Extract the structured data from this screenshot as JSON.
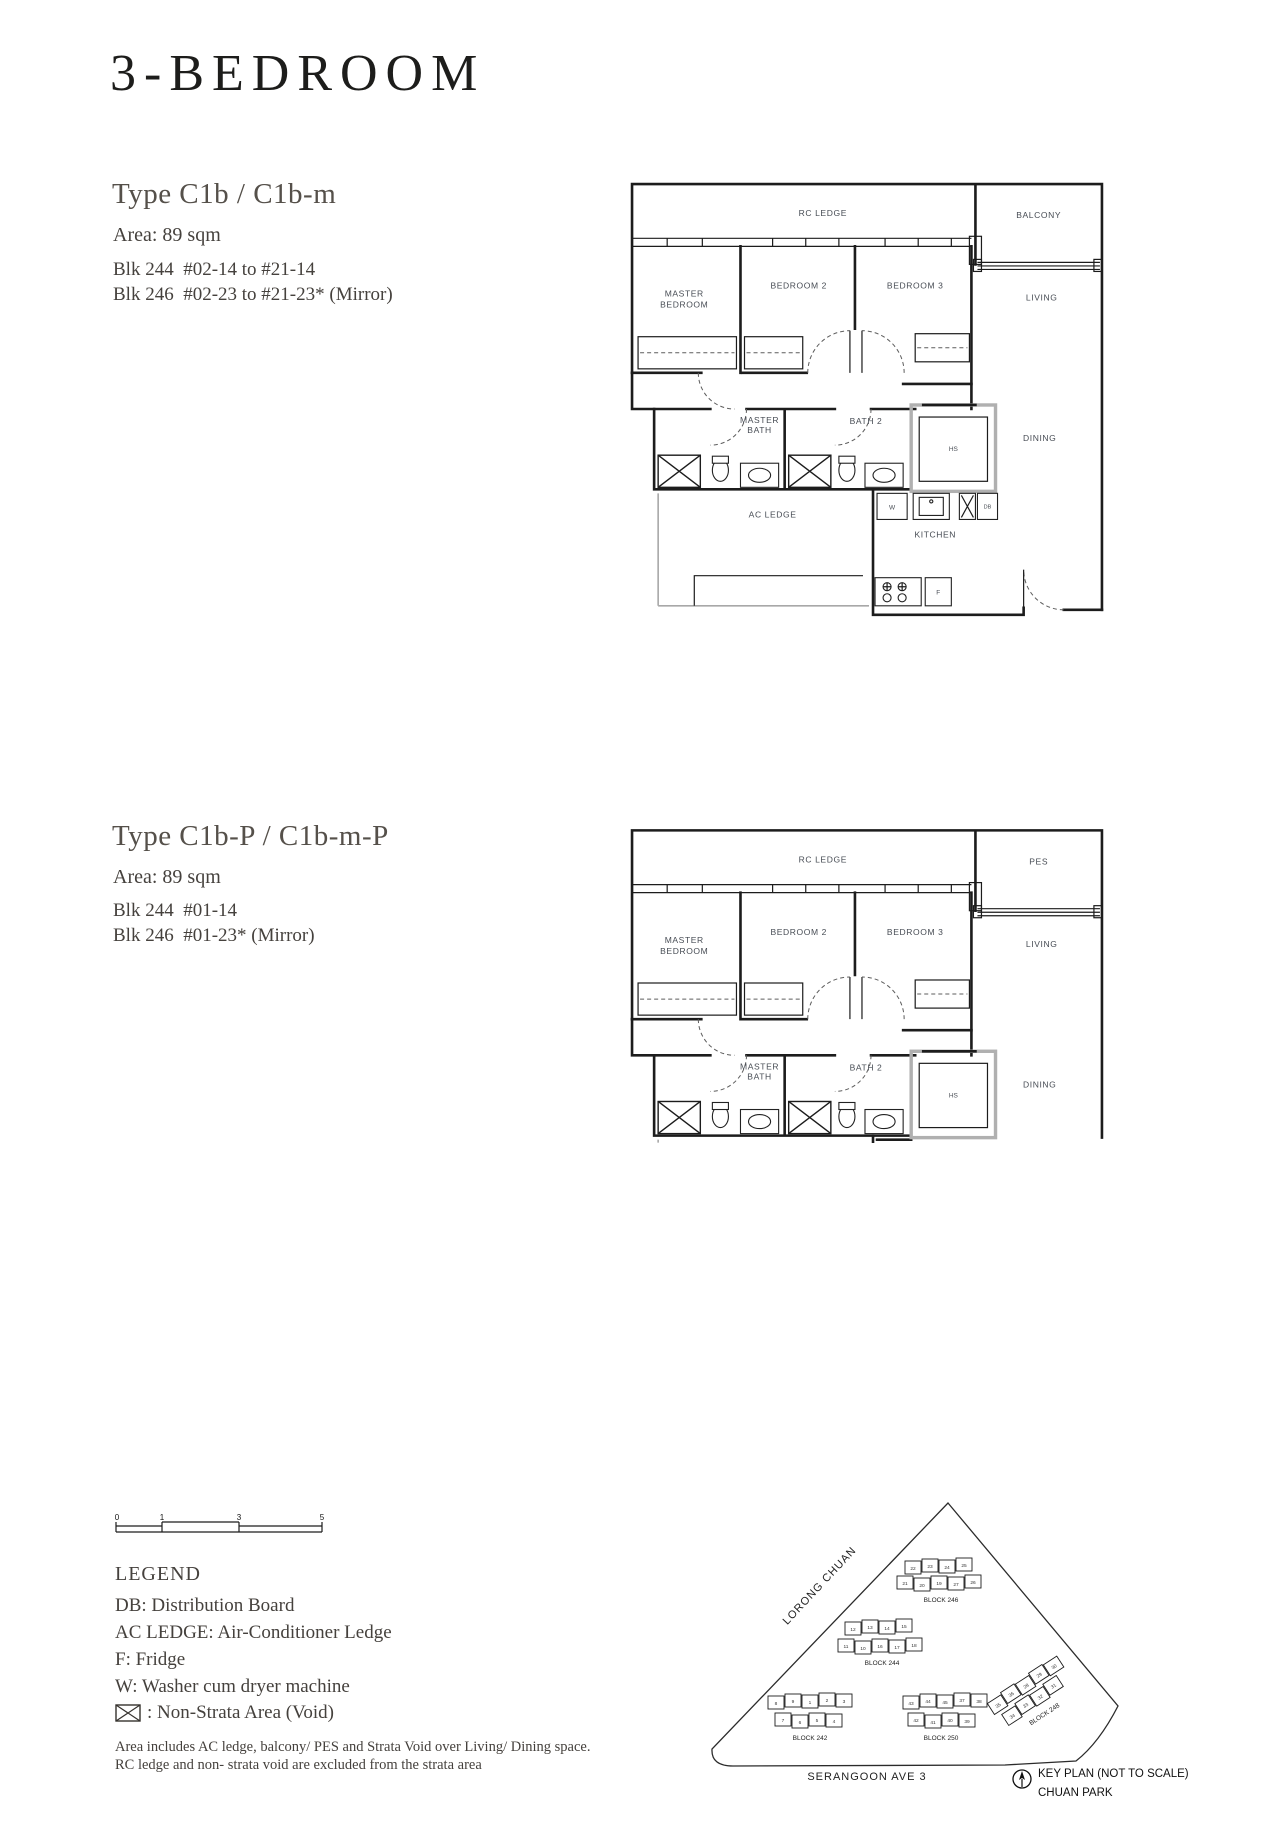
{
  "page": {
    "title": "3-BEDROOM",
    "footer_line1": "Area includes AC ledge, balcony/ PES and Strata Void over Living/ Dining space.",
    "footer_line2": "RC ledge and non- strata void are excluded from the strata area"
  },
  "sections": [
    {
      "type_heading": "Type C1b / C1b-m",
      "area": "Area: 89 sqm",
      "blk_line1": "Blk 244  #02-14 to #21-14",
      "blk_line2": "Blk 246  #02-23 to #21-23* (Mirror)"
    },
    {
      "type_heading": "Type C1b-P / C1b-m-P",
      "area": "Area: 89 sqm",
      "blk_line1": "Blk 244  #01-14",
      "blk_line2": "Blk 246  #01-23* (Mirror)"
    }
  ],
  "plan1": {
    "labels": {
      "rc_ledge": "RC LEDGE",
      "balcony": "BALCONY",
      "master_line1": "MASTER",
      "master_line2": "BEDROOM",
      "bedroom2": "BEDROOM 2",
      "bedroom3": "BEDROOM 3",
      "living": "LIVING",
      "dining": "DINING",
      "master_bath_line1": "MASTER",
      "master_bath_line2": "BATH",
      "bath2": "BATH 2",
      "hs": "HS",
      "ac_ledge": "AC LEDGE",
      "kitchen": "KITCHEN",
      "washer": "W",
      "db": "DB",
      "fridge": "F"
    }
  },
  "plan2": {
    "labels": {
      "rc_ledge": "RC LEDGE",
      "pes": "PES",
      "master_line1": "MASTER",
      "master_line2": "BEDROOM",
      "bedroom2": "BEDROOM 2",
      "bedroom3": "BEDROOM 3",
      "living": "LIVING",
      "dining": "DINING",
      "master_bath_line1": "MASTER",
      "master_bath_line2": "BATH",
      "bath2": "BATH 2",
      "hs": "HS"
    }
  },
  "legend": {
    "heading": "LEGEND",
    "items": [
      "DB: Distribution Board",
      "AC LEDGE: Air-Conditioner Ledge",
      "F: Fridge",
      "W: Washer cum dryer machine"
    ],
    "void_item": ": Non-Strata Area (Void)",
    "scale_ticks": [
      "0",
      "1",
      "3",
      "5"
    ]
  },
  "keyplan": {
    "road_left": "LORONG CHUAN",
    "road_bottom": "SERANGOON AVE 3",
    "caption_line1": "KEY PLAN (NOT TO SCALE)",
    "caption_line2": "CHUAN PARK",
    "highlight_color": "#ead7a0",
    "blocks": [
      {
        "label": "BLOCK 246",
        "row1": [
          "22",
          "23",
          "24",
          "25"
        ],
        "row2": [
          "21",
          "20",
          "19",
          "27",
          "26"
        ],
        "highlight": "23"
      },
      {
        "label": "BLOCK 244",
        "row1": [
          "12",
          "13",
          "14",
          "15"
        ],
        "row2": [
          "11",
          "10",
          "16",
          "17",
          "18"
        ],
        "highlight": "14"
      },
      {
        "label": "BLOCK 242",
        "row1": [
          "8",
          "9",
          "1",
          "2",
          "3"
        ],
        "row2": [
          "7",
          "6",
          "5",
          "4"
        ],
        "highlight": ""
      },
      {
        "label": "BLOCK 250",
        "row1": [
          "43",
          "44",
          "45",
          "37",
          "38"
        ],
        "row2": [
          "42",
          "41",
          "40",
          "39"
        ],
        "highlight": ""
      },
      {
        "label": "BLOCK 248",
        "row1": [
          "35",
          "36",
          "28",
          "29",
          "30"
        ],
        "row2": [
          "34",
          "33",
          "32",
          "31"
        ],
        "highlight": ""
      }
    ]
  }
}
